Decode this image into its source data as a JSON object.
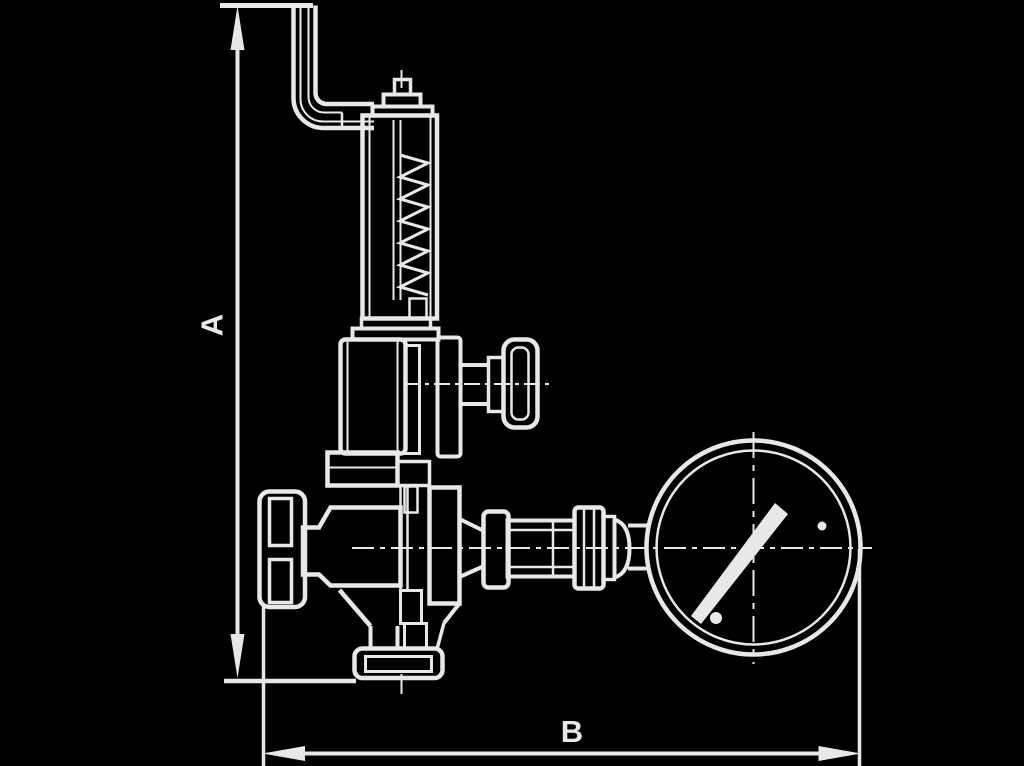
{
  "canvas": {
    "width": 1024,
    "height": 766,
    "background_color": "#000000",
    "line_color": "#e8e8e8"
  },
  "figure": {
    "type": "technical-line-drawing",
    "subject": "Sectional side view of spring-loaded valve with lift lever, handwheel and pressure gauge, with overall dimensions A and B"
  },
  "dimensions": {
    "A": {
      "label": "A",
      "orientation": "vertical"
    },
    "B": {
      "label": "B",
      "orientation": "horizontal"
    }
  }
}
